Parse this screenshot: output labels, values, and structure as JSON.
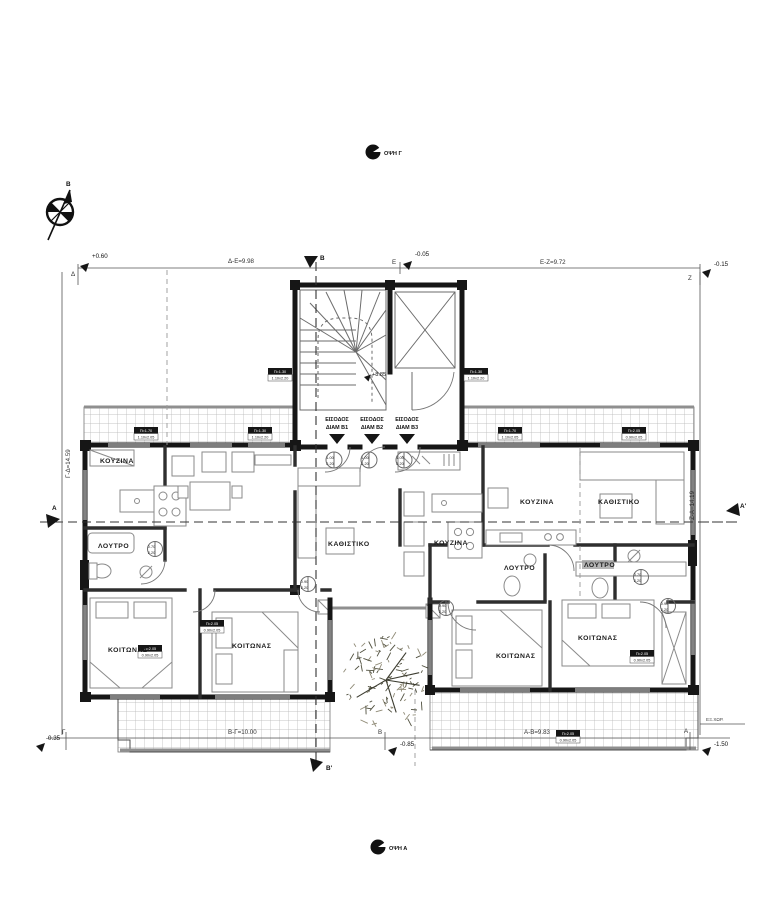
{
  "markers": {
    "view_top": "ΟΨΗ Γ",
    "view_bottom": "ΟΨΗ Α",
    "compass_north": "Β",
    "level": "+8.85",
    "exterior_note": "ΕΞ.ΧΩΡ."
  },
  "sections": {
    "top": "Β",
    "bottom": "Β'",
    "left": "Α",
    "right": "Α'"
  },
  "dimensions": {
    "top_left_offset": "+0.60",
    "top_span_left": "Δ-Ε=9.98",
    "top_mid_offset": "-0.05",
    "top_span_right": "Ε-Ζ=9.72",
    "top_right_offset": "-0.15",
    "bottom_left_offset": "-0.35",
    "bottom_span_left": "Β-Γ=10.00",
    "bottom_mid_offset": "-0.85",
    "bottom_span_right": "Α-Β=9.83",
    "bottom_right_offset": "-1.50",
    "left_span": "Γ-Δ=14.59",
    "right_span": "Ζ-Α=14.19",
    "pt_delta": "Δ",
    "pt_epsilon": "Ε",
    "pt_zeta": "Ζ",
    "pt_gamma": "Γ",
    "pt_beta": "Β",
    "pt_alpha": "Α"
  },
  "entrances": [
    {
      "line1": "ΕΙΣΟΔΟΣ",
      "line2": "ΔΙΑΜ Β1"
    },
    {
      "line1": "ΕΙΣΟΔΟΣ",
      "line2": "ΔΙΑΜ Β2"
    },
    {
      "line1": "ΕΙΣΟΔΟΣ",
      "line2": "ΔΙΑΜ Β3"
    }
  ],
  "rooms": {
    "kitchen_b1": "ΚΟΥΖΙΝΑ",
    "bath_b1": "ΛΟΥΤΡΟ",
    "bedroom_b1": "ΚΟΙΤΩΝΑΣ",
    "bedroom_b2": "ΚΟΙΤΩΝΑΣ",
    "living_b2": "ΚΑΘΙΣΤΙΚΟ",
    "kitchen_b2": "ΚΟΥΖΙΝΑ",
    "kitchen_b3": "ΚΟΥΖΙΝΑ",
    "living_b3": "ΚΑΘΙΣΤΙΚΟ",
    "bath_b3a": "ΛΟΥΤΡΟ",
    "bath_b3b": "ΛΟΥΤΡΟ",
    "bedroom_b3a": "ΚΟΙΤΩΝΑΣ",
    "bedroom_b3b": "ΚΟΙΤΩΝΑΣ"
  },
  "window_tags": {
    "t170": {
      "w": "Π=1.70",
      "s": "1.10x2.05"
    },
    "t130": {
      "w": "Π=1.30",
      "s": "1.10x2.20"
    },
    "t205": {
      "w": "Π=2.05",
      "s": "0.90x2.05"
    }
  },
  "door_tags": {
    "entrance": {
      "l1": "1.00",
      "l2": "2.20"
    },
    "bath": {
      "l1": "0.70",
      "l2": "2.20"
    },
    "bedroom": {
      "l1": "0.90",
      "l2": "2.20"
    }
  },
  "colors": {
    "wall": "#161616",
    "line": "#666666",
    "hatch": "#b3b3b3",
    "railing": "#8f8f8f",
    "text": "#222222"
  }
}
